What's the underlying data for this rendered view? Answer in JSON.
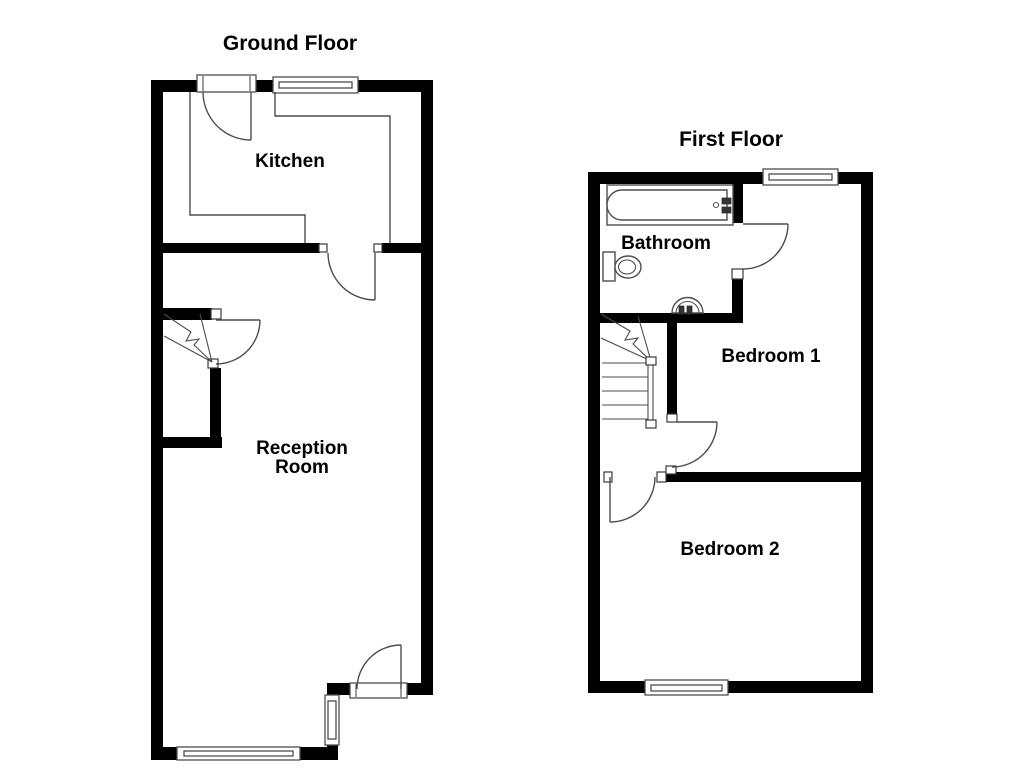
{
  "floorplan": {
    "ground_floor": {
      "title": "Ground Floor",
      "labels": {
        "kitchen": "Kitchen",
        "reception_line1": "Reception",
        "reception_line2": "Room"
      },
      "features": [
        "entrance-door",
        "kitchen-window",
        "kitchen-counter",
        "staircase",
        "stairs-door",
        "kitchen-reception-door",
        "rear-door",
        "rear-side-window",
        "front-reception-window"
      ]
    },
    "first_floor": {
      "title": "First Floor",
      "labels": {
        "bathroom": "Bathroom",
        "bedroom1": "Bedroom 1",
        "bedroom2": "Bedroom 2"
      },
      "features": [
        "bathtub",
        "toilet",
        "basin",
        "staircase",
        "bathroom-door",
        "bedroom1-door",
        "bedroom2-door",
        "bedroom1-window",
        "bedroom2-window"
      ]
    },
    "colors": {
      "wall": "#000000",
      "thin_line": "#4d4d4d",
      "background": "#ffffff",
      "text": "#000000"
    }
  }
}
